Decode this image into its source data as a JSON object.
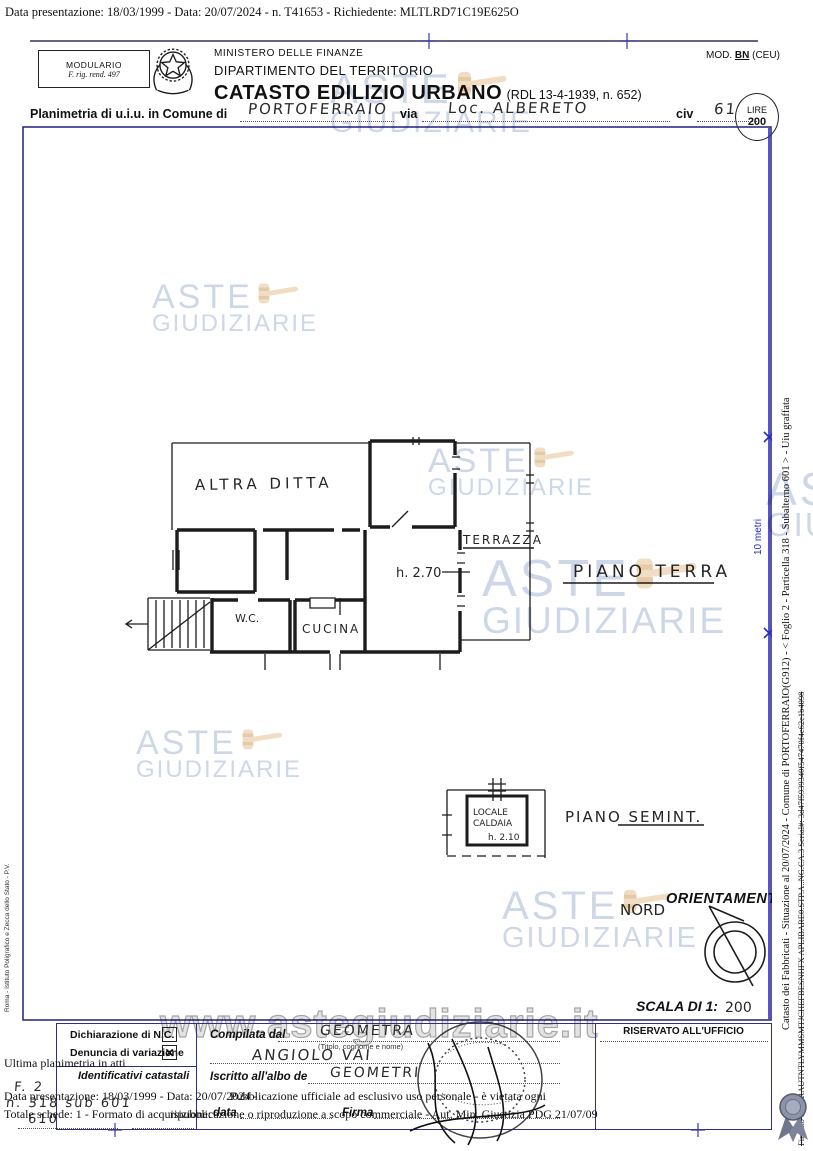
{
  "page": {
    "top_line": "Data presentazione: 18/03/1999 - Data: 20/07/2024 - n. T41653 - Richiedente: MLTLRD71C19E625O"
  },
  "header": {
    "modulario_1": "MODULARIO",
    "modulario_2": "F. rig. rend. 497",
    "ministry_1": "MINISTERO DELLE FINANZE",
    "ministry_2": "DIPARTIMENTO DEL TERRITORIO",
    "title": "CATASTO EDILIZIO URBANO",
    "title_ref": "(RDL 13-4-1939, n. 652)",
    "mod_prefix": "MOD.",
    "mod_code": "BN",
    "mod_suffix": "(CEU)",
    "lire_label": "LIRE",
    "lire_value": "200",
    "planimetria_label": "Planimetria di u.i.u. in Comune di",
    "comune_value": "PORTOFERRAIO",
    "via_label": "via",
    "via_value": "Loc. ALBERETO",
    "civ_label": "civ",
    "civ_value": "61"
  },
  "plan": {
    "altra_ditta": "ALTRA DITTA",
    "terrazza": "TERRAZZA",
    "room_height": "h. 2.70",
    "wc": "W.C.",
    "cucina": "CUCINA",
    "floor_label": "PIANO TERRA",
    "caldaia_1": "LOCALE",
    "caldaia_2": "CALDAIA",
    "caldaia_h": "h. 2.10",
    "semint_label": "PIANO SEMINT.",
    "orientamento": "ORIENTAMENTO",
    "nord": "NORD",
    "scala_label": "SCALA DI 1:",
    "scala_value": "200",
    "scalebar_label": "10 metri"
  },
  "watermark": {
    "brand_top": "ASTE",
    "brand_bottom": "GIUDIZIARIE",
    "url": "www.astegiudiziarie.it",
    "text_color": "#adbcd8",
    "gavel_color": "#e5c091",
    "gavel_dark": "#cf9d5f"
  },
  "margins": {
    "left_vertical": "Roma - Istituto Poligrafico e Zecca dello Stato - P.V.",
    "right_info": "Catasto dei Fabbricati - Situazione al 20/07/2024 - Comune di PORTOFERRAIO(G912) - <  Foglio 2 - Particella  318 - Subalterno 601 >  - Uiu graffata",
    "right_signature": "Firmato DS:TRAUTNTLYMMSMTJCHEFBESNHFX APLIBARE0.STP.A..NG.CA.3 Serial#: 3d47f5939340f547470f4e62e1b4098"
  },
  "footer": {
    "decl_nc": "Dichiarazione di N.C.",
    "decl_var": "Denuncia di variazione",
    "check_mark": "✕",
    "identificativi": "Identificativi catastali",
    "hw_foglio": "F. 2",
    "hw_part": "n. 318  sub  601",
    "hw_extra": "610",
    "compilata": "Compilata dal",
    "compilata_hw": "GEOMETRA",
    "titolo_note": "(Titolo, cognome e nome)",
    "nome_hw": "ANGIOLO  VAI",
    "iscritto": "Iscritto all'albo de",
    "iscritto_hw": "GEOMETRI",
    "data_label": "data",
    "firma_label": "Firma",
    "riservato": "RISERVATO ALL'UFFICIO"
  },
  "overlay": {
    "ultima": "Ultima planimetria in atti",
    "line2_a": "Data presentazione: 18/03/1999 - Data: 20/07/2024 -",
    "line2_b": "Pubblicazione ufficiale ad esclusivo uso personale - è vietata ogni",
    "line3_a": "Totale schede: 1 - Formato di acquisizione:",
    "line3_b": "ripubblicazione o riproduzione a scopo commerciale - Aut. Min. Giustizia PDG 21/07/09"
  }
}
